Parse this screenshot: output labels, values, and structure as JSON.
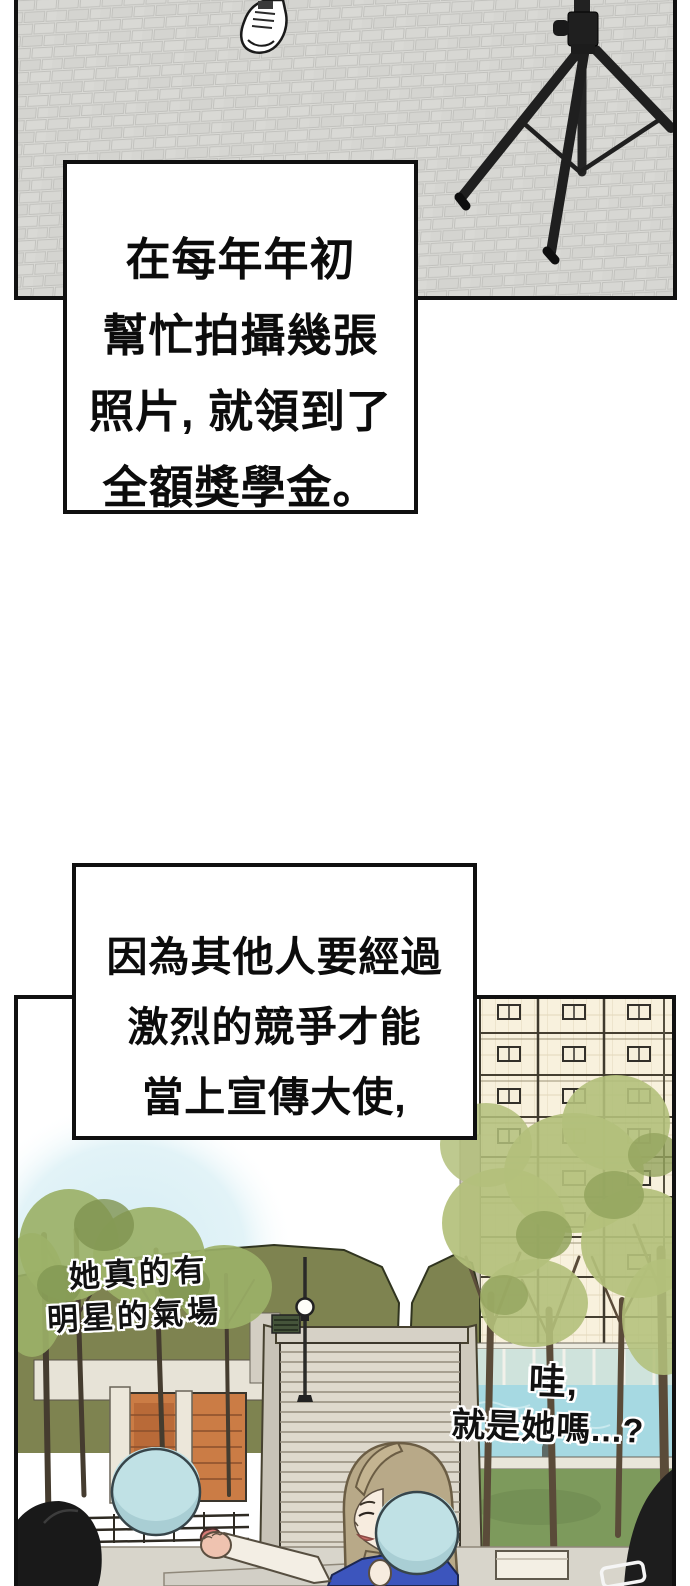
{
  "page": {
    "kind": "webtoon-comic-page"
  },
  "narration1": {
    "lines": [
      "在每年年初",
      "幫忙拍攝幾張",
      "照片, 就領到了",
      "全額獎學金。"
    ]
  },
  "narration2": {
    "lines": [
      "因為其他人要經過",
      "激烈的競爭才能",
      "當上宣傳大使,"
    ]
  },
  "handwritten_left": {
    "lines": [
      "她真的有",
      "明星的氣場"
    ]
  },
  "handwritten_right": {
    "lines": [
      "哇,",
      "就是她嗎...?"
    ]
  },
  "colors": {
    "panel_border": "#111111",
    "brick_paving": "#d9d9d5",
    "tripod_black": "#1f1f1f",
    "hill_green": "#7e8350",
    "building_cream": "#f8f1dd",
    "stairs_gray": "#ded9cd",
    "pool_blue": "#a6d9e2",
    "lawn_green": "#7d9a5c",
    "foliage_green": "#b3c07b",
    "paddle_blue": "#c0e1e5",
    "hair_tan": "#b8a988",
    "shirt_blue": "#3c55bd",
    "sky_patch_blue": "#cfeaf2",
    "brick_building_orange": "#cb7c45"
  }
}
